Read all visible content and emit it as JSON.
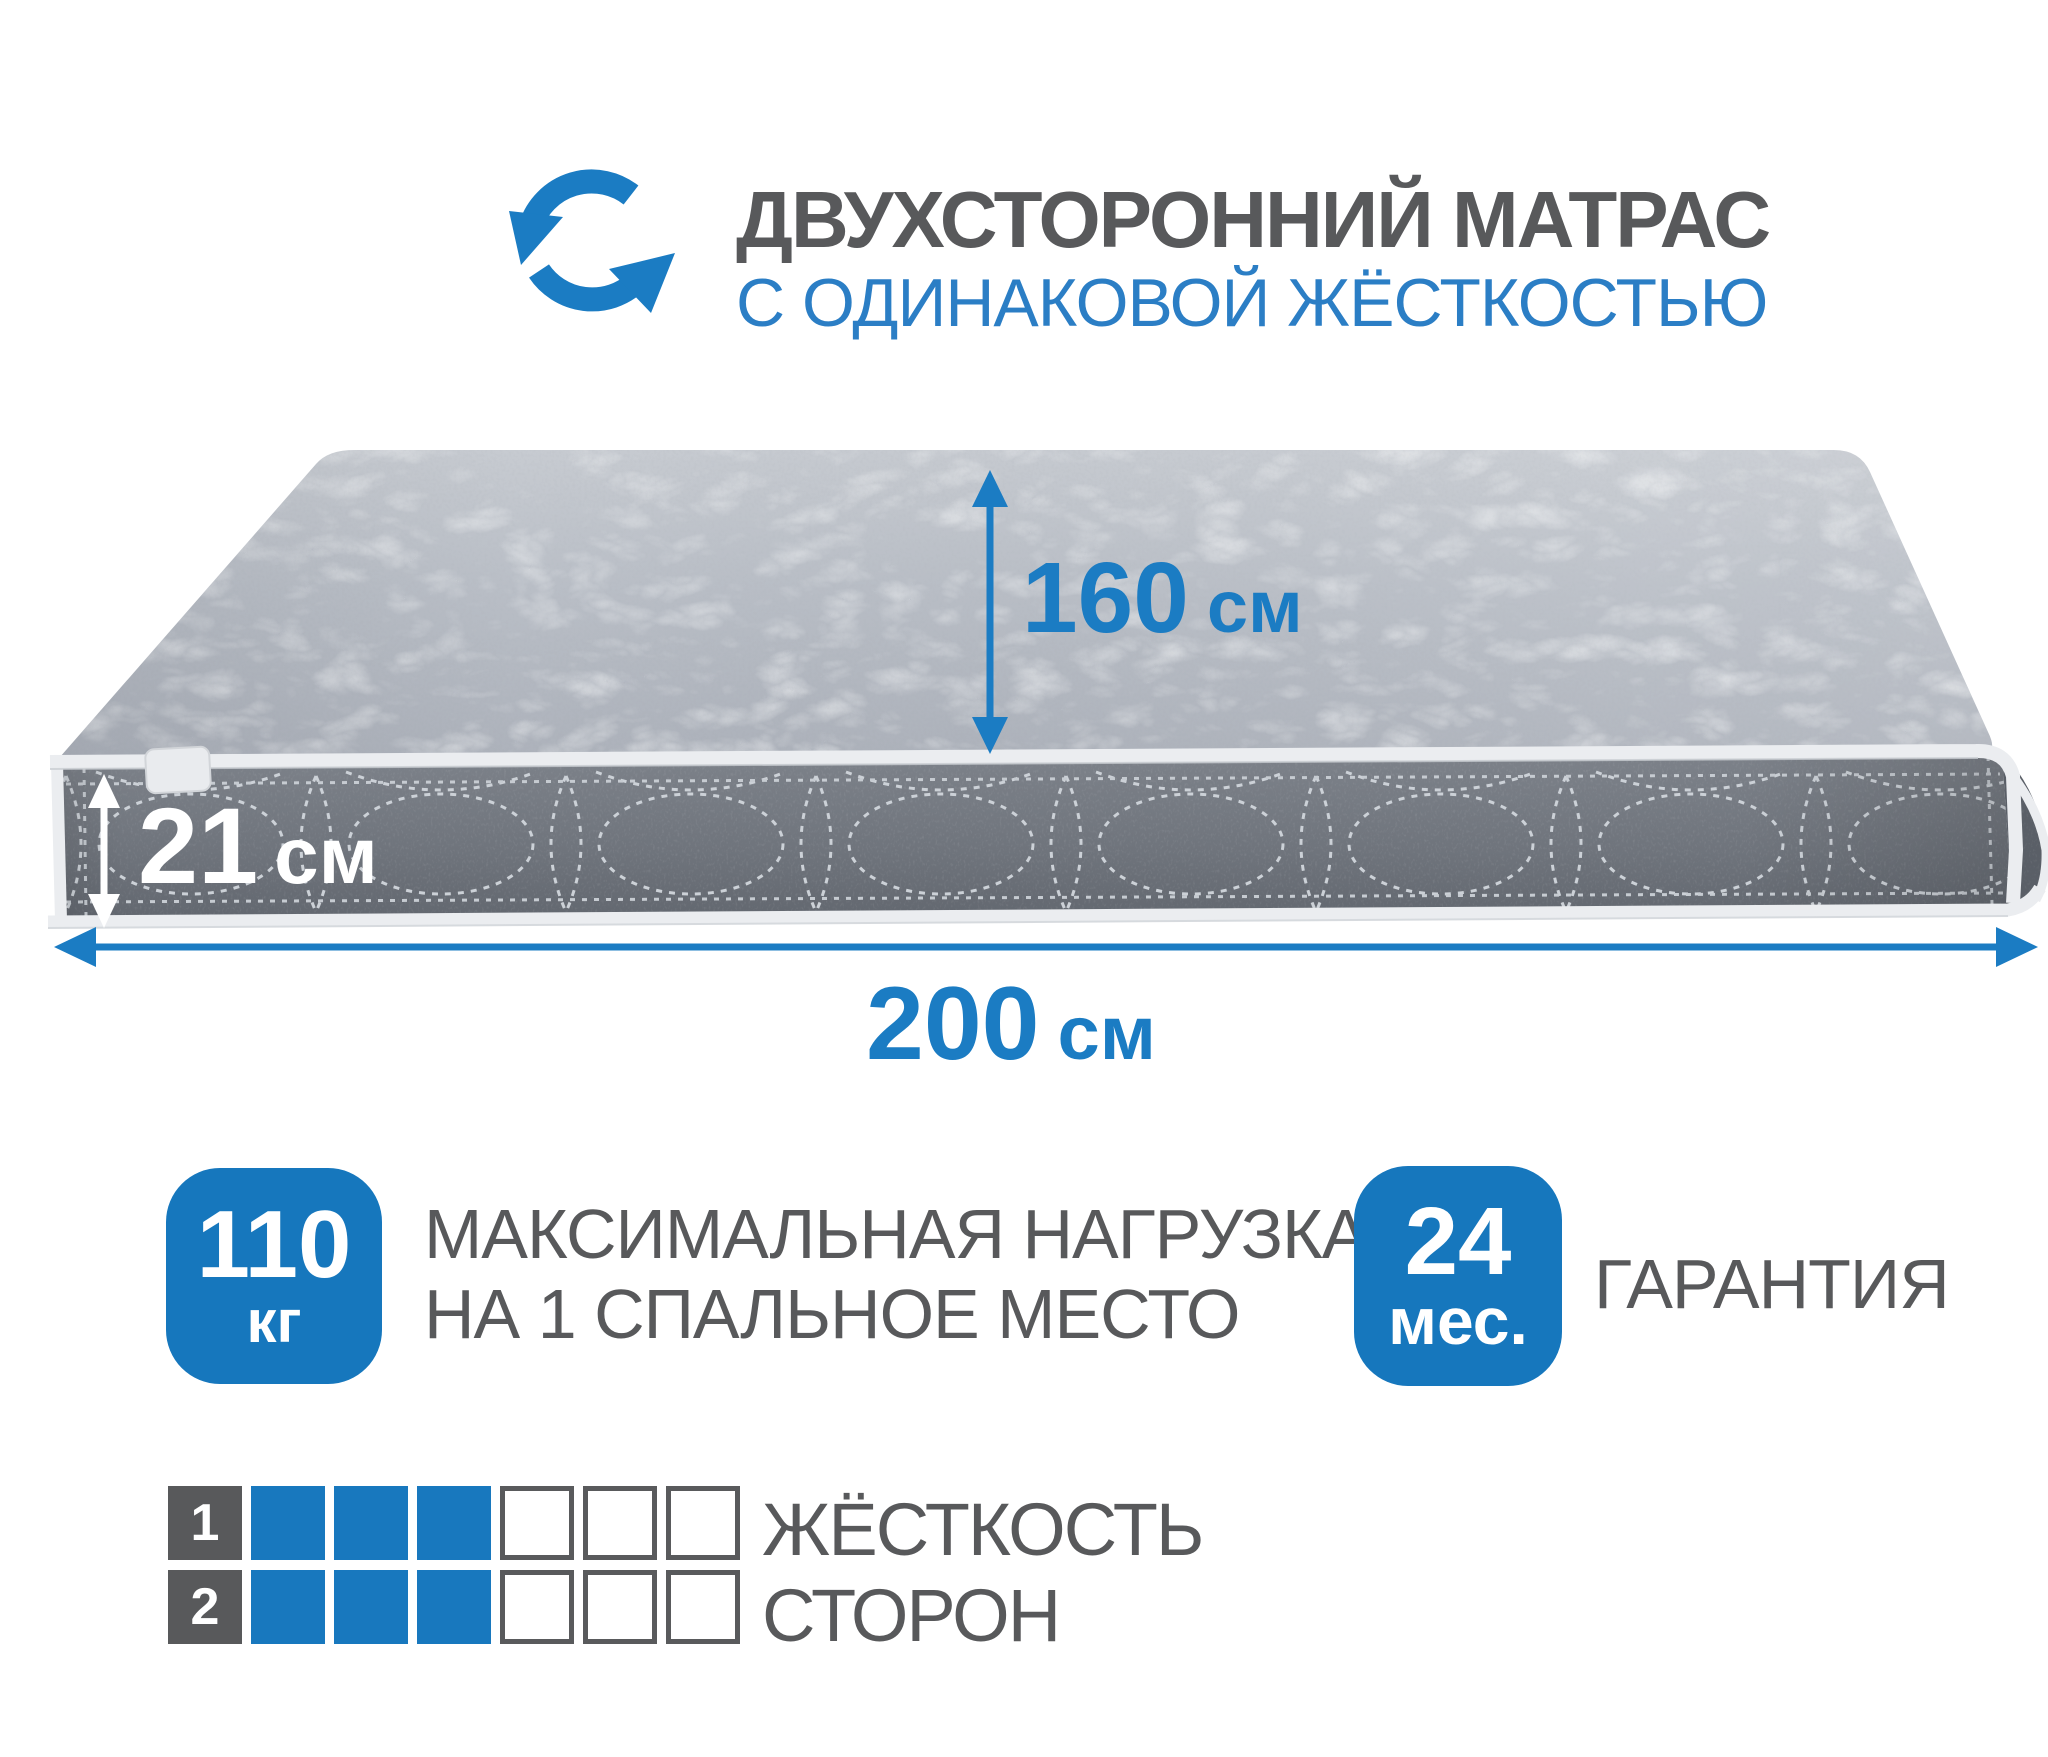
{
  "colors": {
    "accent": "#1b7cc3",
    "badge_blue": "#1677bd",
    "square_blue": "#1878be",
    "text_gray": "#58595b",
    "title_blue": "#2b7ec5",
    "mattress_top": "#b6bbc3",
    "mattress_side": "#70757d"
  },
  "header": {
    "icon": "rotate-arrows-icon",
    "title_line1": "ДВУХСТОРОННИЙ МАТРАС",
    "title_line2": "С ОДИНАКОВОЙ ЖЁСТКОСТЬЮ"
  },
  "dimensions": {
    "width": {
      "value": "160",
      "unit": "см"
    },
    "thickness": {
      "value": "21",
      "unit": "см"
    },
    "length": {
      "value": "200",
      "unit": "см"
    }
  },
  "features": {
    "max_load": {
      "value": "110",
      "unit": "кг",
      "label_line1": "МАКСИМАЛЬНАЯ НАГРУЗКА",
      "label_line2": "НА 1 СПАЛЬНОЕ МЕСТО"
    },
    "warranty": {
      "value": "24",
      "unit": "мес.",
      "label": "ГАРАНТИЯ"
    }
  },
  "firmness": {
    "label_line1": "ЖЁСТКОСТЬ",
    "label_line2": "СТОРОН",
    "scale_total": 6,
    "rows": [
      {
        "side": "1",
        "filled": 3
      },
      {
        "side": "2",
        "filled": 3
      }
    ]
  }
}
